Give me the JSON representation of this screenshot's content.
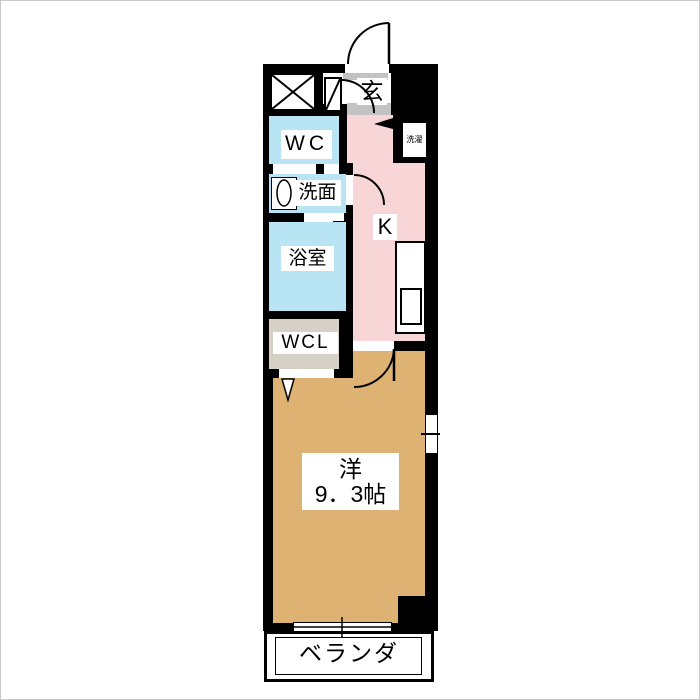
{
  "floorplan": {
    "type": "apartment-floor-plan",
    "rooms": {
      "genkan": {
        "label": "玄"
      },
      "wc": {
        "label": "WC"
      },
      "senmen": {
        "label": "洗面"
      },
      "bath": {
        "label": "浴室"
      },
      "wcl": {
        "label": "WCL"
      },
      "kitchen": {
        "label": "K"
      },
      "laundry": {
        "label": "洗濯"
      },
      "western": {
        "label": "洋",
        "size": "9．3帖"
      },
      "veranda": {
        "label": "ベランダ"
      }
    },
    "colors": {
      "wall": "#000000",
      "wet_rooms": "#b8e4f4",
      "kitchen": "#f8d6d8",
      "western_room": "#deb272",
      "closet": "#d6d1c6",
      "entry_step": "#c3c3c3",
      "background": "#ffffff"
    }
  }
}
